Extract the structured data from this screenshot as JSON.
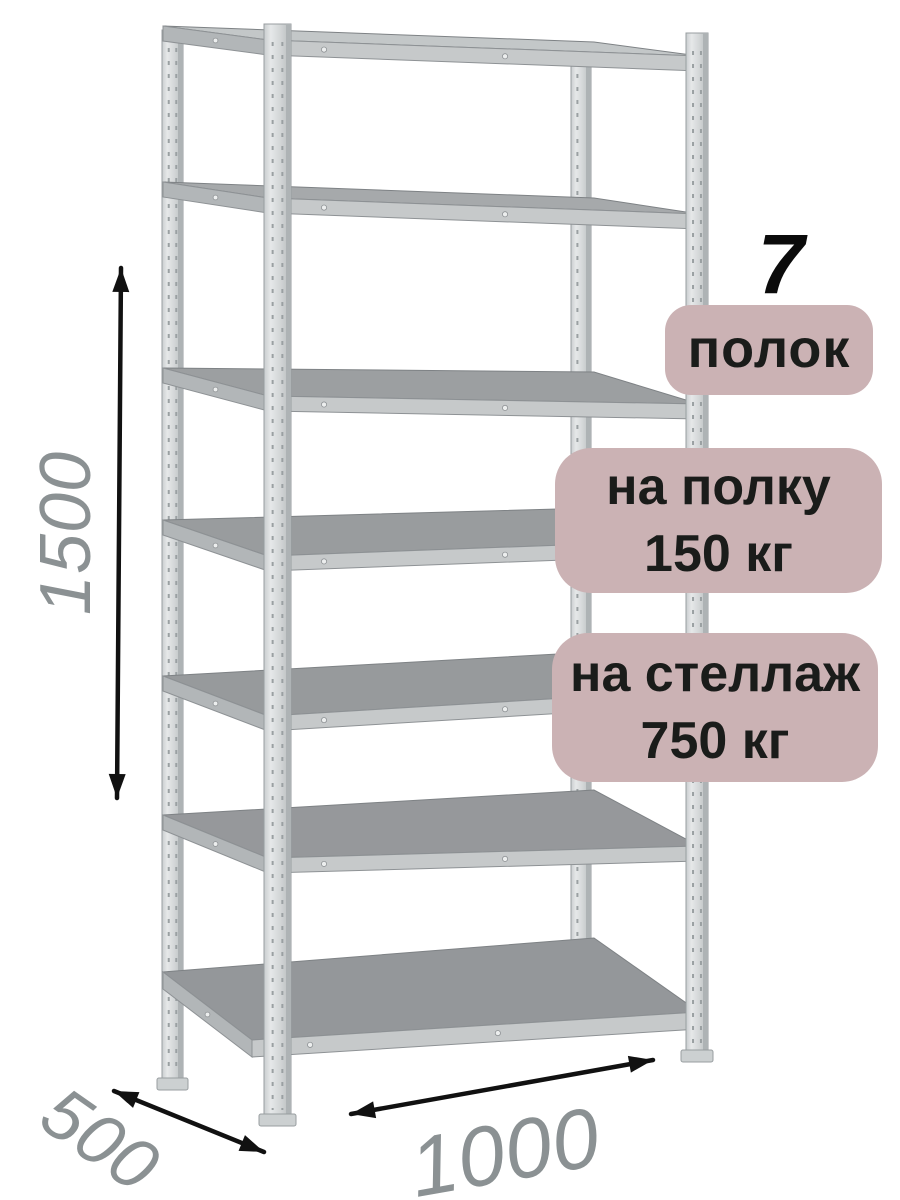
{
  "badges": {
    "count_number": "7",
    "count_label": "полок",
    "per_shelf": {
      "line1": "на полку",
      "line2": "150 кг"
    },
    "per_rack": {
      "line1": "на стеллаж",
      "line2": "750 кг"
    }
  },
  "dimensions": {
    "height_mm": "1500",
    "depth_mm": "500",
    "width_mm": "1000"
  },
  "rack": {
    "shelf_count": 7
  },
  "colors": {
    "background": "#ffffff",
    "badge_bg": "#cbb2b4",
    "badge_text": "#1a1c1a",
    "dim_text": "#8b9193",
    "arrow": "#111111",
    "shelf_top": "#9a9da0",
    "shelf_band": "#c6c9ca",
    "shelf_band_side": "#b2b6b8",
    "post_light": "#e6e8e9",
    "post_dark": "#b6bbbd"
  }
}
